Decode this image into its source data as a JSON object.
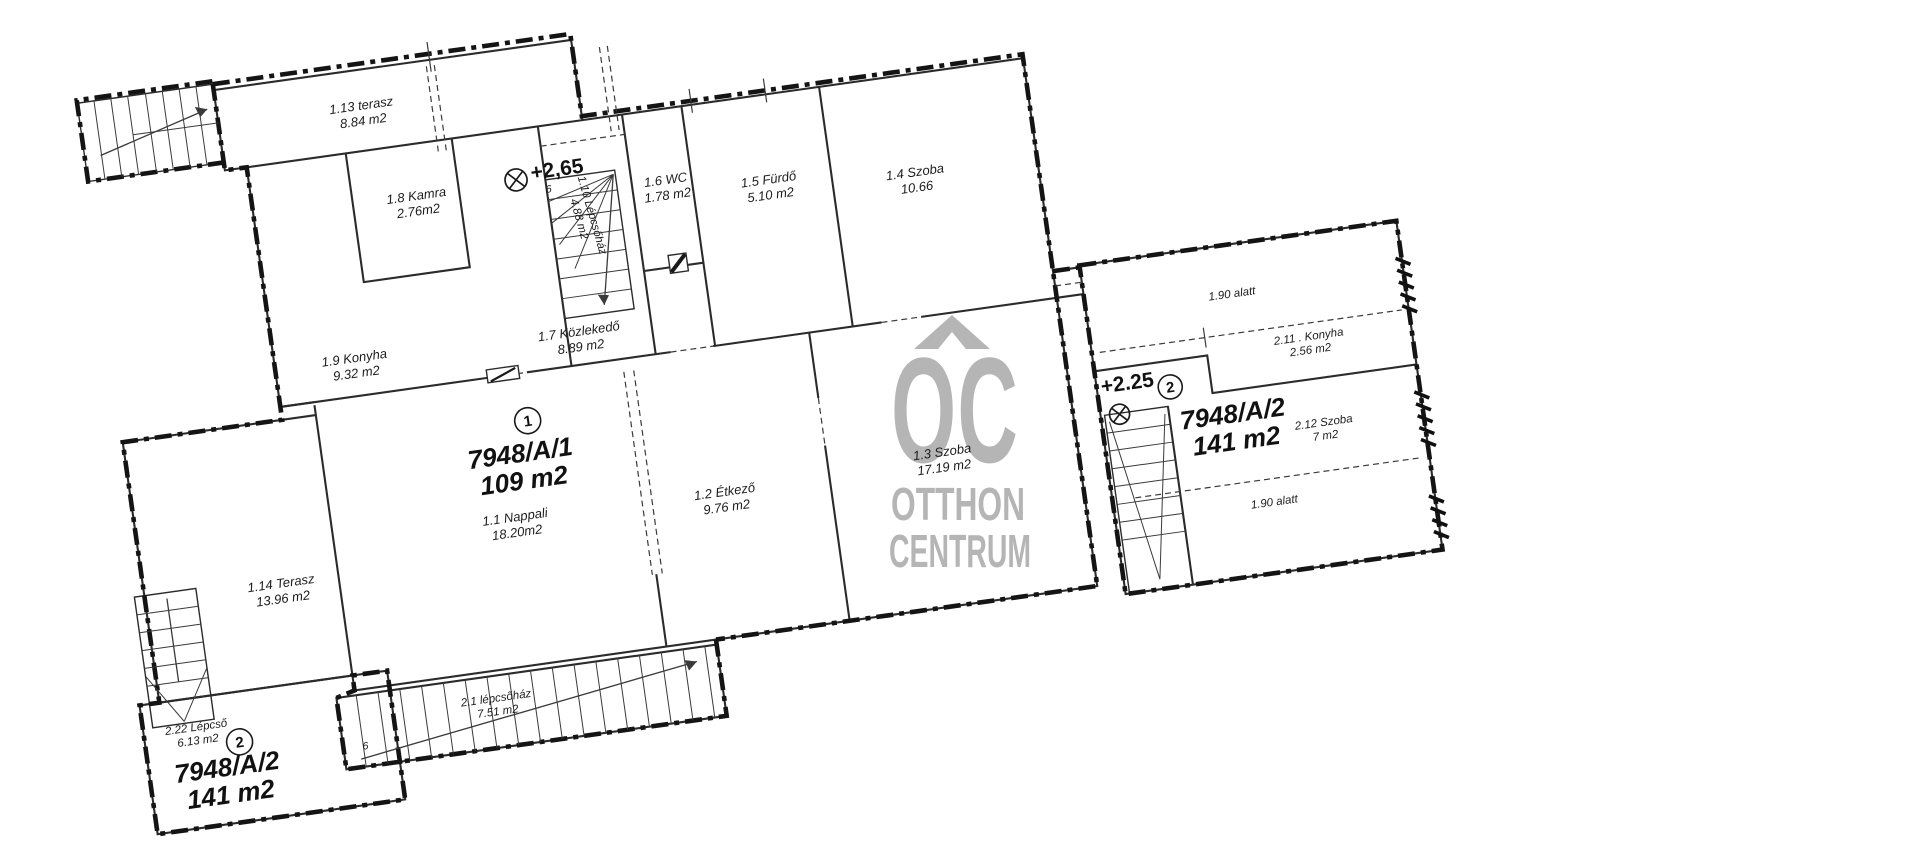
{
  "page": {
    "background": "#ffffff",
    "kind": "scanned floor plan"
  },
  "watermark": {
    "line1": "OC",
    "line2": "OTTHON",
    "line3": "CENTRUM",
    "color": "#b5b5b5"
  },
  "units": [
    {
      "badge": "1",
      "parcel": "7948/A/1",
      "area": "109 m2"
    },
    {
      "badge": "2",
      "parcel": "7948/A/2",
      "area": "141 m2"
    }
  ],
  "level_markers": [
    {
      "text": "+2,65",
      "note": "6"
    },
    {
      "text": "+2.25"
    }
  ],
  "notes": [
    "1.90 alatt",
    "1.90 alatt"
  ],
  "rooms": [
    {
      "number": "1.1",
      "name": "Nappali",
      "area": "18.20m2"
    },
    {
      "number": "1.2",
      "name": "Étkező",
      "area": "9.76 m2"
    },
    {
      "number": "1.3",
      "name": "Szoba",
      "area": "17.19 m2"
    },
    {
      "number": "1.4",
      "name": "Szoba",
      "area": "10.66"
    },
    {
      "number": "1.5",
      "name": "Fürdő",
      "area": "5.10 m2"
    },
    {
      "number": "1.6",
      "name": "WC",
      "area": "1.78 m2"
    },
    {
      "number": "1.7",
      "name": "Közlekedő",
      "area": "8.89 m2"
    },
    {
      "number": "1.8",
      "name": "Kamra",
      "area": "2.76m2"
    },
    {
      "number": "1.9",
      "name": "Konyha",
      "area": "9.32 m2"
    },
    {
      "number": "1.10",
      "name": "Lépcsőház",
      "area": "4.88 m2"
    },
    {
      "number": "1.13",
      "name": "terasz",
      "area": "8.84 m2"
    },
    {
      "number": "1.14",
      "name": "Terasz",
      "area": "13.96 m2"
    },
    {
      "number": "2.1",
      "name": "lépcsőház",
      "area": "7.51 m2"
    },
    {
      "number": "2.11",
      "name": "Konyha",
      "area": "2.56 m2"
    },
    {
      "number": "2.12",
      "name": "Szoba",
      "area": "7 m2"
    },
    {
      "number": "2.22",
      "name": "Lépcső",
      "area": "6.13 m2"
    }
  ],
  "labels": [
    {
      "name": "room-label-1-13-terasz",
      "lines": [
        "1.13 terasz",
        "8.84 m2"
      ],
      "x": 343,
      "y": 159,
      "style": "room"
    },
    {
      "name": "room-label-1-8-kamra",
      "lines": [
        "1.8 Kamra",
        "2.76m2"
      ],
      "x": 385,
      "y": 256,
      "style": "room"
    },
    {
      "name": "room-label-1-10-lepcsohaz",
      "lines": [
        "1.10 Lépcsőház",
        "4.88 m2"
      ],
      "x": 553,
      "y": 296,
      "style": "small",
      "rot": 82
    },
    {
      "name": "room-label-1-6-wc",
      "lines": [
        "1.6 WC",
        "1.78 m2"
      ],
      "x": 634,
      "y": 275,
      "style": "room"
    },
    {
      "name": "room-label-1-5-furdo",
      "lines": [
        "1.5 Fürdő",
        "5.10 m2"
      ],
      "x": 736,
      "y": 289,
      "style": "room"
    },
    {
      "name": "room-label-1-4-szoba",
      "lines": [
        "1.4 Szoba",
        "10.66"
      ],
      "x": 882,
      "y": 302,
      "style": "room"
    },
    {
      "name": "room-label-1-7-kozlekedo",
      "lines": [
        "1.7 Közlekedő",
        "8.89 m2"
      ],
      "x": 527,
      "y": 413,
      "style": "room"
    },
    {
      "name": "room-label-1-9-konyha",
      "lines": [
        "1.9 Konyha",
        "9.32 m2"
      ],
      "x": 301,
      "y": 408,
      "style": "room"
    },
    {
      "name": "unit-1-parcel-label",
      "lines": [
        "7948/A/1",
        "109 m2"
      ],
      "x": 452,
      "y": 530,
      "style": "big"
    },
    {
      "name": "room-label-1-1-nappali",
      "lines": [
        "1.1 Nappali",
        "18.20m2"
      ],
      "x": 438,
      "y": 588,
      "style": "room"
    },
    {
      "name": "room-label-1-2-etkezo",
      "lines": [
        "1.2 Étkező",
        "9.76 m2"
      ],
      "x": 649,
      "y": 592,
      "style": "room"
    },
    {
      "name": "room-label-1-3-szoba",
      "lines": [
        "1.3 Szoba",
        "17.19 m2"
      ],
      "x": 870,
      "y": 583,
      "style": "room"
    },
    {
      "name": "room-label-1-14-terasz",
      "lines": [
        "1.14 Terasz",
        "13.96 m2"
      ],
      "x": 197,
      "y": 621,
      "style": "room"
    },
    {
      "name": "room-label-2-22-lepcso",
      "lines": [
        "2.22 Lépcső",
        "6.13 m2"
      ],
      "x": 93,
      "y": 751,
      "style": "small"
    },
    {
      "name": "unit-2-parcel-label-bottom",
      "lines": [
        "7948/A/2",
        "141 m2"
      ],
      "x": 118,
      "y": 800,
      "style": "big"
    },
    {
      "name": "room-label-2-1-lepcsohaz",
      "lines": [
        "2.1 lépcsőház",
        "7.51 m2"
      ],
      "x": 394,
      "y": 764,
      "style": "small"
    },
    {
      "name": "stair-number-note",
      "lines": [
        "6"
      ],
      "x": 258,
      "y": 793,
      "style": "tiny"
    },
    {
      "name": "level-marker-265",
      "lines": [
        "+2,65"
      ],
      "x": 528,
      "y": 252,
      "style": "marker"
    },
    {
      "name": "level-marker-265-note",
      "lines": [
        "6"
      ],
      "x": 517,
      "y": 267,
      "style": "tiny"
    },
    {
      "name": "note-190-alatt-top",
      "lines": [
        "1.90 alatt"
      ],
      "x": 1179,
      "y": 466,
      "style": "small"
    },
    {
      "name": "room-label-2-11-konyha",
      "lines": [
        "2.11 . Konyha",
        "2.56 m2"
      ],
      "x": 1249,
      "y": 519,
      "style": "small"
    },
    {
      "name": "level-marker-225",
      "lines": [
        "+2.25"
      ],
      "x": 1063,
      "y": 543,
      "style": "marker"
    },
    {
      "name": "unit-2-parcel-label-right",
      "lines": [
        "7948/A/2",
        "141 m2"
      ],
      "x": 1163,
      "y": 590,
      "style": "big"
    },
    {
      "name": "room-label-2-12-szoba",
      "lines": [
        "2.12 Szoba",
        "7 m2"
      ],
      "x": 1252,
      "y": 606,
      "style": "small"
    },
    {
      "name": "note-190-alatt-bottom",
      "lines": [
        "1.90 alatt"
      ],
      "x": 1192,
      "y": 678,
      "style": "small"
    }
  ],
  "badges": [
    {
      "name": "unit-1-badge",
      "n": "1",
      "x": 464,
      "y": 490,
      "r": 13
    },
    {
      "name": "unit-2-badge-bottom",
      "n": "2",
      "x": 134,
      "y": 768,
      "r": 13
    },
    {
      "name": "unit-2-badge-right",
      "n": "2",
      "x": 1105,
      "y": 546,
      "r": 12
    }
  ],
  "oplus_markers": [
    {
      "name": "elevation-mark-265",
      "x": 486,
      "y": 250,
      "r": 11
    },
    {
      "name": "elevation-mark-225",
      "x": 1051,
      "y": 566,
      "r": 10
    }
  ]
}
